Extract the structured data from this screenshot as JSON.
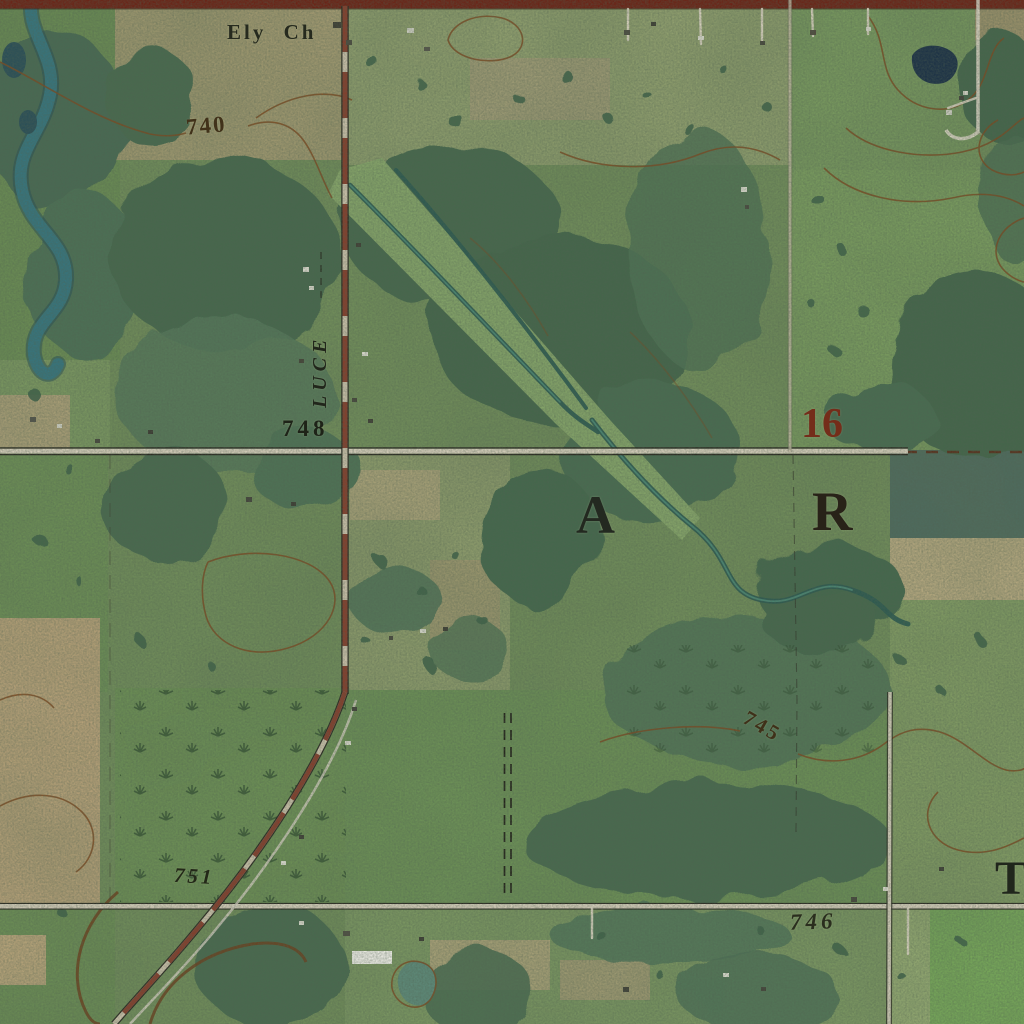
{
  "map": {
    "description": "USGS-style topographic contour map overlaid on aerial orthoimagery",
    "labels": {
      "church": "Ely Ch",
      "road_name": "LUCE",
      "section_number": "16",
      "survey_letter_a": "A",
      "survey_letter_r": "R",
      "survey_letter_t": "T",
      "contour_740": "740",
      "contour_745": "745",
      "spot_elevation_748": "748",
      "spot_elevation_751": "751",
      "spot_elevation_746": "746"
    },
    "palette": {
      "field_green": "#74915c",
      "forest_green": "#486a50",
      "plowed_tan": "#c2a77e",
      "river_teal": "#37747c",
      "pond_navy": "#1d3246",
      "contour_brown": "#7a4a22",
      "road_red": "#7e3322",
      "road_gray": "#d2cbb8",
      "section_number_red": "#742d1a",
      "label_black": "#23281e",
      "dark_crop_field": "#4e6b60"
    }
  }
}
